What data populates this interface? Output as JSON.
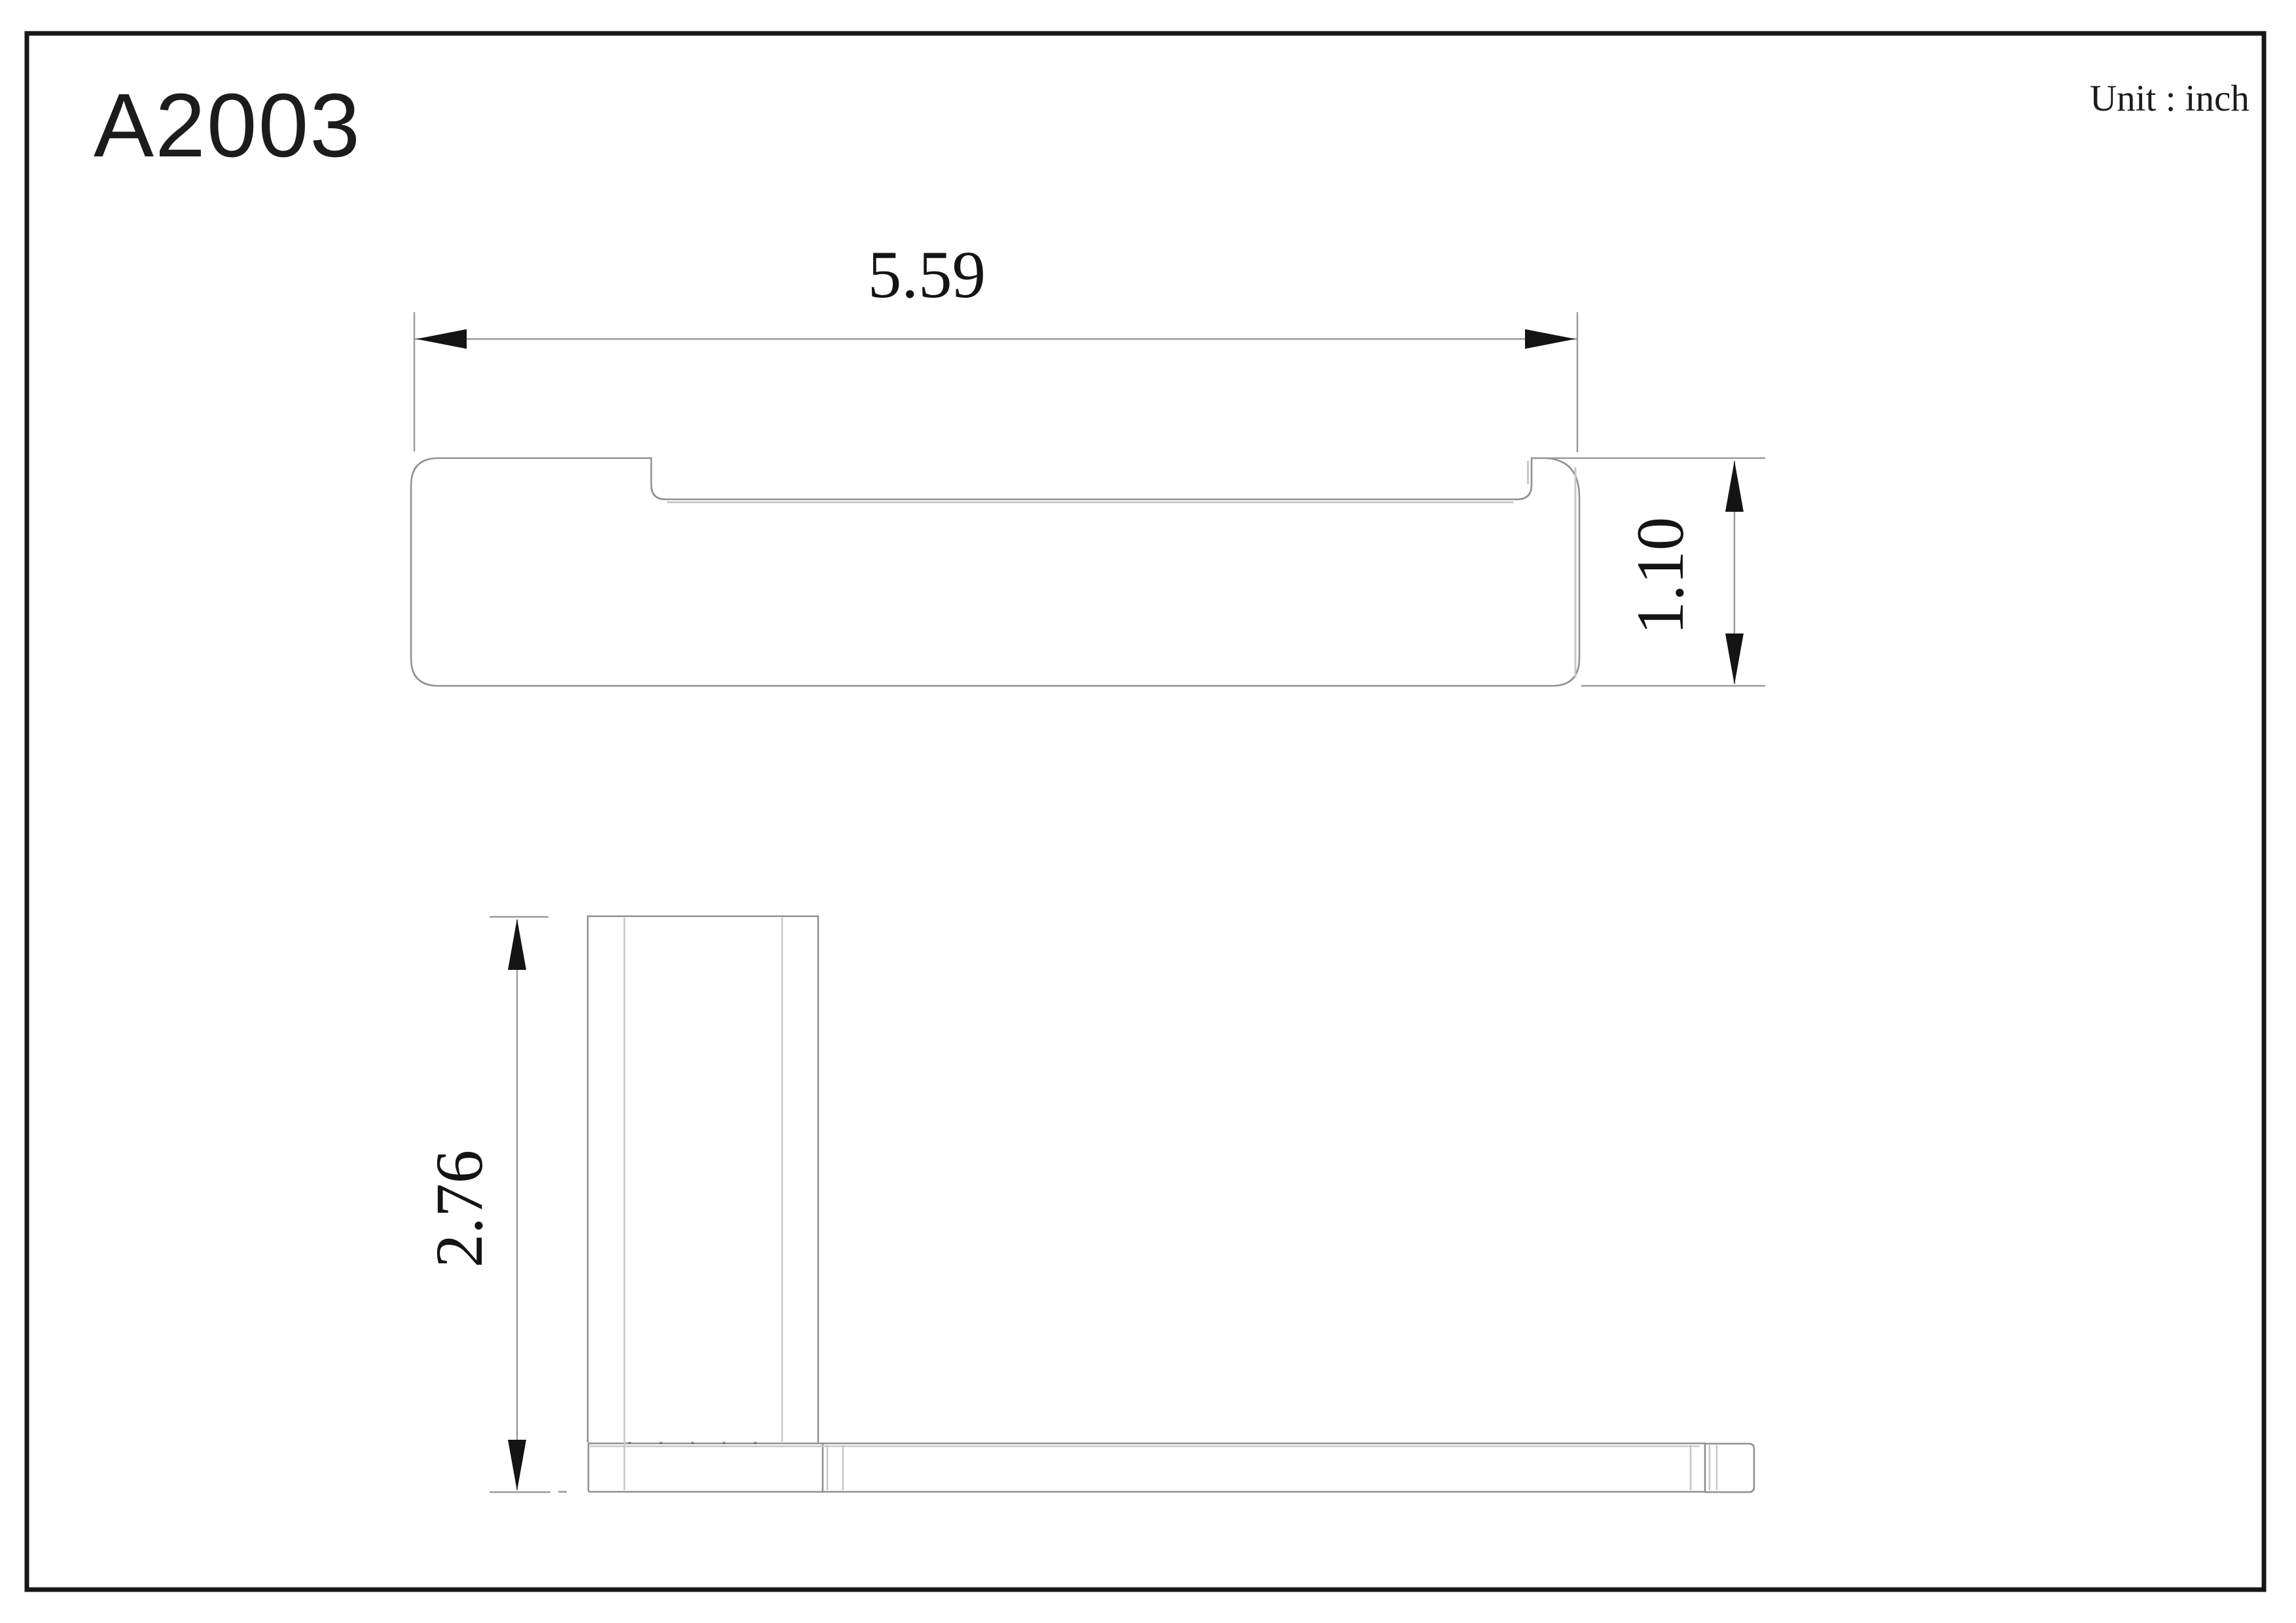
{
  "drawing": {
    "part_number": "A2003",
    "unit_label": "Unit : inch",
    "dimensions": {
      "top_view_width": "5.59",
      "top_view_height": "1.10",
      "side_view_height": "2.76"
    },
    "colors": {
      "ink": "#1c1c1c",
      "outline_gray": "#8e9092",
      "tangent_gray": "#c6c8ca",
      "dimension_gray": "#97999b"
    }
  }
}
